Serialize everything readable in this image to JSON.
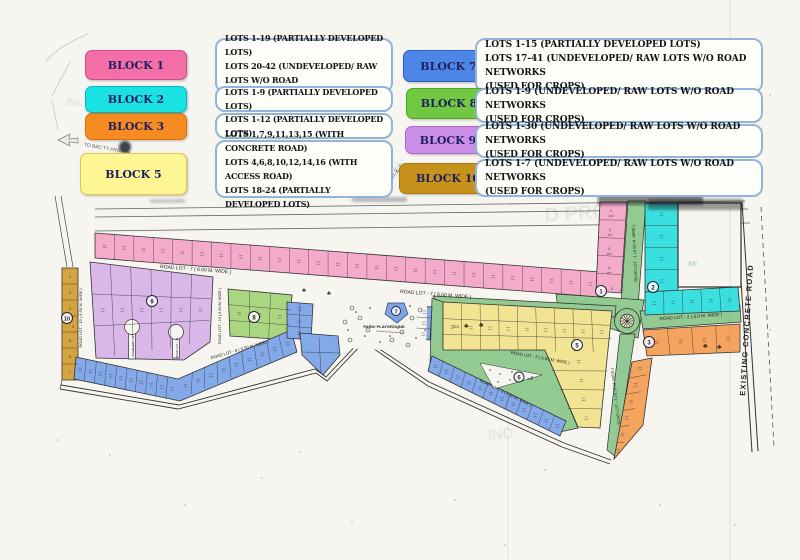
{
  "legend": {
    "blocks": [
      {
        "label": "BLOCK 1",
        "color": "#f46ea8",
        "lines": [
          "LOTS 1-19  (PARTIALLY DEVELOPED LOTS)",
          "LOTS 20-42 (UNDEVELOPED/ RAW LOTS W/O ROAD",
          "NETWORKS (USED FOR CROPS)"
        ]
      },
      {
        "label": "BLOCK 2",
        "color": "#1ae2e2",
        "lines": [
          "LOTS 1-9   (PARTIALLY DEVELOPED LOTS)"
        ]
      },
      {
        "label": "BLOCK 3",
        "color": "#f68b22",
        "lines": [
          "LOTS 1-12  (PARTIALLY DEVELOPED LOTS)"
        ]
      },
      {
        "label": "BLOCK 5",
        "color": "#fdf692",
        "lines": [
          "LOTS 1,7,9,11,13,15 (WITH CONCRETE ROAD)",
          "LOTS 4,6,8,10,12,14,16 (WITH ACCESS ROAD)",
          "LOTS 18-24 (PARTIALLY DEVELOPED LOTS)"
        ]
      },
      {
        "label": "BLOCK 7",
        "color": "#4e86e8",
        "lines": [
          "LOTS 1-15  (PARTIALLY DEVELOPED LOTS)",
          "LOTS 17-41 (UNDEVELOPED/ RAW LOTS W/O ROAD NETWORKS",
          "(USED FOR CROPS)"
        ]
      },
      {
        "label": "BLOCK 8",
        "color": "#72c840",
        "lines": [
          "LOTS 1-9 (UNDEVELOPED/ RAW LOTS W/O ROAD NETWORKS",
          "(USED FOR CROPS)"
        ]
      },
      {
        "label": "BLOCK 9",
        "color": "#cb8fe9",
        "lines": [
          "LOTS 1-30 (UNDEVELOPED/ RAW LOTS W/O ROAD NETWORKS",
          "(USED FOR CROPS)"
        ]
      },
      {
        "label": "BLOCK 10",
        "color": "#c6921c",
        "lines": [
          "LOTS 1-7 (UNDEVELOPED/ RAW LOTS W/O ROAD NETWORKS",
          "(USED FOR CROPS)"
        ]
      }
    ]
  },
  "map": {
    "road_labels": {
      "road_1": "ROAD LOT - 1 ( 6.50 M. WIDE )",
      "road_2": "ROAD LOT - 2  ( 6.0 M. WIDE )",
      "road_3": "ROAD LOT - 3 ( 6.50 M. WIDE )",
      "road_5": "ROAD LOT - 5  ( 6.50 M. WIDE )",
      "road_6": "ROAD LOT - 6 ( 6.50 M. WIDE )",
      "road_7_west": "ROAD LOT - 7  ( 6.50 M. WIDE )",
      "road_7_east": "ROAD LOT - 7  ( 6.50 M. WIDE )",
      "road_8": "ROAD LOT - 8  ( 6.50 M. WIDE )",
      "road_10": "ROAD LOT - 10 ( 6.50 M. WIDE )",
      "road_11": "ROAD LOT - 11",
      "road_12": "ROAD LOT - 12",
      "road_13": "ROAD LOT - 13  ( 6.50 M. WIDE )",
      "existing_road": "EXISTING CONCRETE ROAD"
    },
    "markers": {
      "b1": "1",
      "b2": "2",
      "b3": "3",
      "b5": "5",
      "b6": "6",
      "b7": "7",
      "b8": "8",
      "b9": "9",
      "b10": "10"
    },
    "park_label": "PARK/ PLAYGROUND",
    "annotations": {
      "to_city_proper": "TO BAC  TY PROPER",
      "mc_note": "Mc",
      "road_fragment": "L RO",
      "lot_area_108": "108",
      "lot_area_124": "124"
    },
    "block10_lot_numbers": [
      "1",
      "2",
      "3",
      "4",
      "5",
      "6",
      "7"
    ],
    "block1_east_lots": {
      "numbers": [
        "1",
        "2",
        "3",
        "4",
        "5"
      ],
      "areas": [
        "137",
        "157",
        "157",
        "157"
      ]
    },
    "watermarks": [
      "D PROP",
      "PROPERTY",
      "IND",
      "INL"
    ]
  }
}
